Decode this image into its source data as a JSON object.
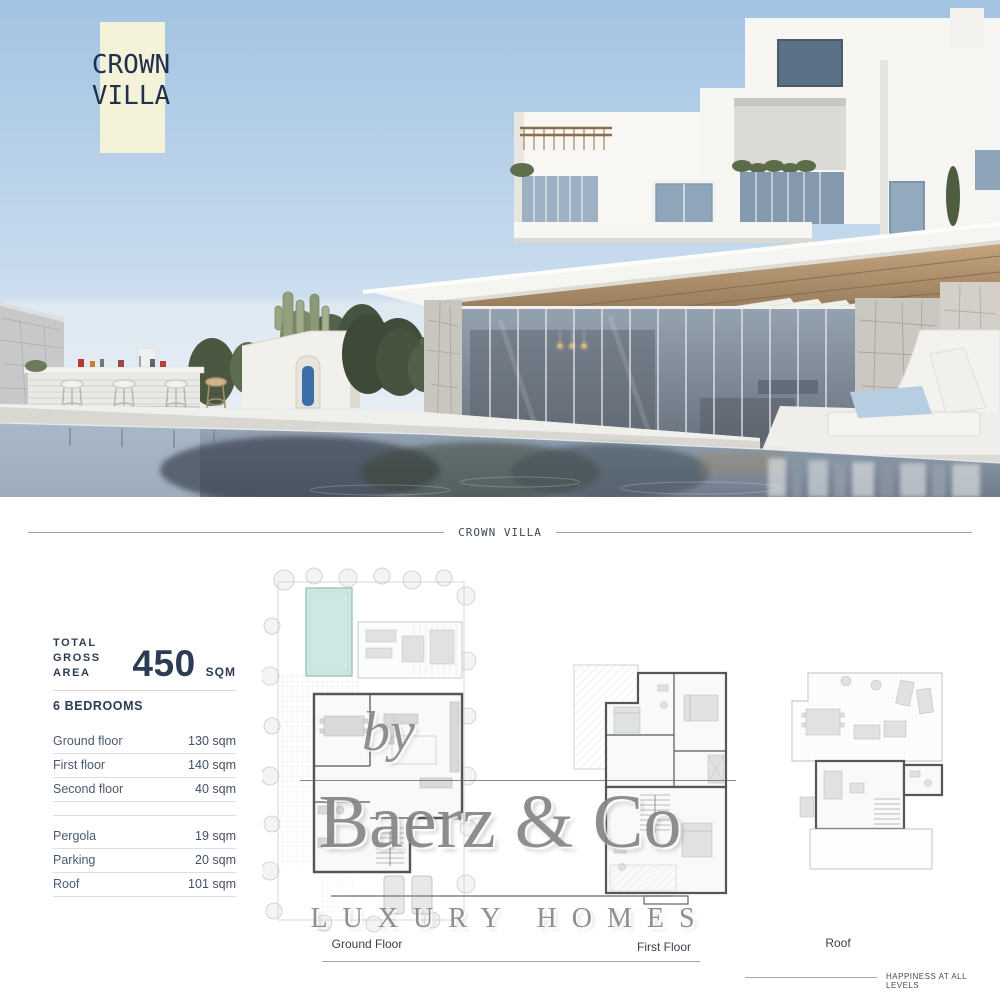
{
  "hero": {
    "badge": {
      "line1": "CROWN",
      "line2": "VILLA",
      "bg": "#f5f2da",
      "text_color": "#22304a"
    }
  },
  "section_divider": {
    "label": "CROWN VILLA"
  },
  "stats": {
    "total": {
      "label_line1": "TOTAL",
      "label_line2": "GROSS AREA",
      "value": "450",
      "unit": "SQM"
    },
    "bedrooms_label": "6 BEDROOMS",
    "floors": [
      {
        "label": "Ground floor",
        "value": "130 sqm"
      },
      {
        "label": "First floor",
        "value": "140 sqm"
      },
      {
        "label": "Second floor",
        "value": "40 sqm"
      }
    ],
    "extras": [
      {
        "label": "Pergola",
        "value": "19 sqm"
      },
      {
        "label": "Parking",
        "value": "20 sqm"
      },
      {
        "label": "Roof",
        "value": "101 sqm"
      }
    ]
  },
  "plans": {
    "ground_label": "Ground Floor",
    "first_label": "First Floor",
    "roof_label": "Roof",
    "pool_color": "#cde8e3"
  },
  "watermark": {
    "prefix": "by",
    "brand": "Baerz & Co",
    "tagline": "LUXURY HOMES"
  },
  "footer": {
    "motto": "HAPPINESS AT ALL LEVELS"
  }
}
